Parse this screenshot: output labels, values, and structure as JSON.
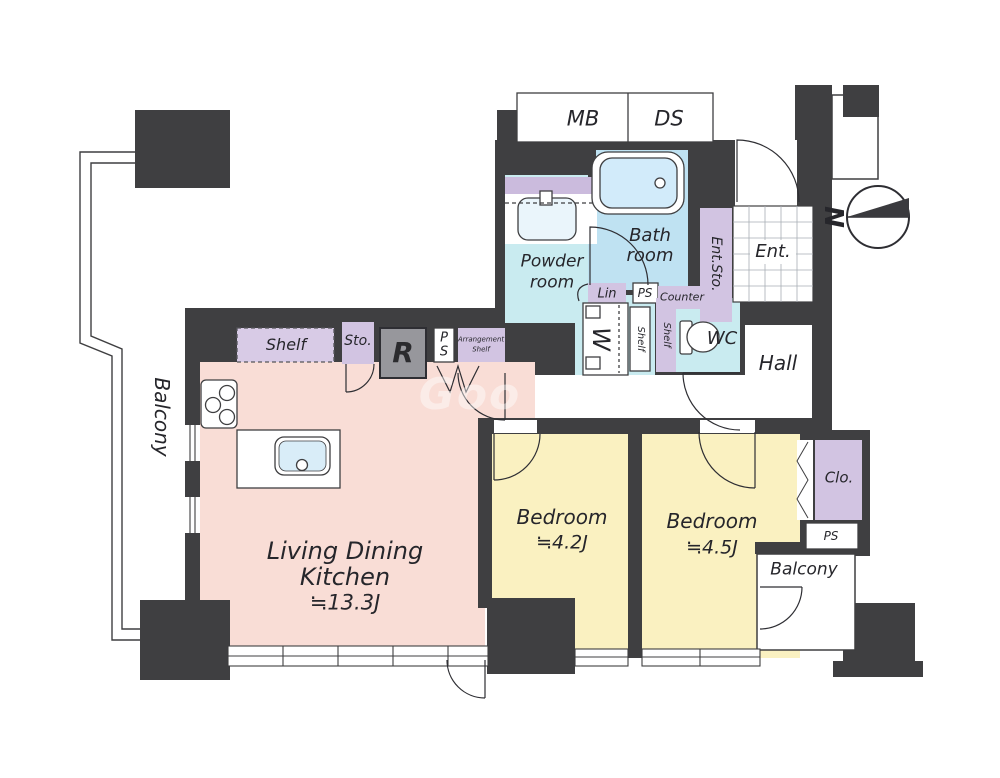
{
  "compass": {
    "label": "N"
  },
  "watermark": {
    "text": "Goo"
  },
  "rooms": {
    "ldk": {
      "line1": "Living Dining",
      "line2": "Kitchen",
      "area": "≒13.3J"
    },
    "bedroom1": {
      "name": "Bedroom",
      "area": "≒4.2J"
    },
    "bedroom2": {
      "name": "Bedroom",
      "area": "≒4.5J"
    },
    "bath": {
      "line1": "Bath",
      "line2": "room"
    },
    "powder": {
      "line1": "Powder",
      "line2": "room"
    },
    "wc": {
      "name": "WC"
    },
    "hall": {
      "name": "Hall"
    },
    "entrance": {
      "name": "Ent."
    },
    "entrance_storage": {
      "name": "Ent.Sto."
    },
    "balcony_left": {
      "name": "Balcony"
    },
    "balcony_right": {
      "name": "Balcony"
    },
    "closet": {
      "name": "Clo."
    }
  },
  "fixtures": {
    "meter_box": "MB",
    "duct_space": "DS",
    "shelf": "Shelf",
    "storage": "Sto.",
    "refrigerator": "R",
    "pipe_space_kitchen_p": "P",
    "pipe_space_kitchen_s": "S",
    "arrangement_shelf_line1": "Arrangement",
    "arrangement_shelf_line2": "Shelf",
    "linen": "Lin",
    "pipe_space_top": "PS",
    "counter": "Counter",
    "washer": "W",
    "shelf_vertical_1": "Shelf",
    "shelf_vertical_2": "Shelf",
    "pipe_space_right": "PS"
  },
  "colors": {
    "wall": "#3f3f41",
    "ldk_floor": "#f9ddd6",
    "bedroom_floor": "#faf1c1",
    "wet_floor": "#c9ebf0",
    "bath_floor": "#bfe2f2",
    "tub": "#d2ebfa",
    "cabinet_purple": "#d2c4e2",
    "refrigerator_gray": "#97979c"
  }
}
